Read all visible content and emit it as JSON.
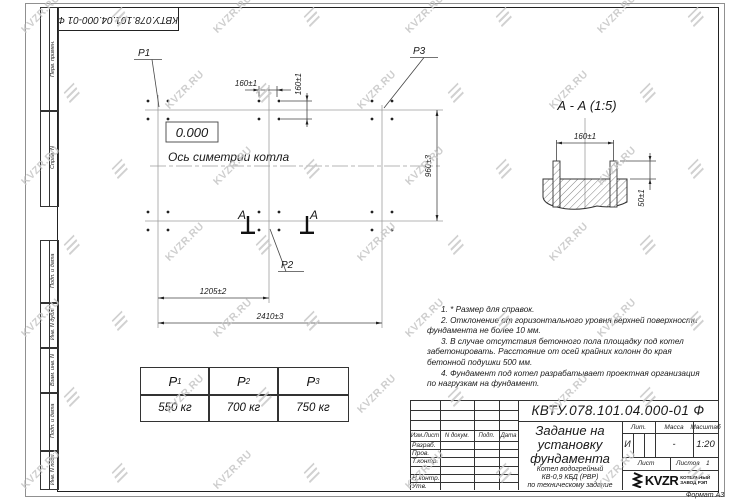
{
  "watermark": {
    "text": "KVZR.RU"
  },
  "frame": {
    "doc_number_top": "КВТУ.078.101.04.000-01 Ф",
    "margin_fields_top": [
      "Перв. примен.",
      "Справ. N"
    ],
    "margin_fields_bottom": [
      "Подп. и дата",
      "Инв. N дубл.",
      "Взам. инв. N",
      "Подп. и дата",
      "Инв. N подл."
    ],
    "format_label": "Формат А3"
  },
  "plan": {
    "level_mark": "0.000",
    "axis_label": "Ось симетрии котла",
    "labels": {
      "p1": "P1",
      "p2": "P2",
      "p3": "P3"
    },
    "section_letter": "А",
    "dims": {
      "bolt_h": "160±1",
      "bolt_v": "160±1",
      "width": "960±3",
      "half": "1205±2",
      "total": "2410±3"
    }
  },
  "section_view": {
    "title": "А - А (1:5)",
    "dims": {
      "spacing": "160±1",
      "height": "50±1"
    }
  },
  "notes": [
    "1. * Размер для справок.",
    "2. Отклонение от горизонтального уровня верхней поверхности фундамента не более 10 мм.",
    "3. В случае отсутствия бетонного пола площадку под котел забетонировать. Расстояние от осей крайних колонн до края бетонной подушки 500 мм.",
    "4. Фундамент под котел разрабатывает проектная организация по нагрузкам на фундамент."
  ],
  "loads_table": {
    "columns": [
      {
        "name": "P",
        "sub": "1",
        "value": "550 кг"
      },
      {
        "name": "P",
        "sub": "2",
        "value": "700 кг"
      },
      {
        "name": "P",
        "sub": "3",
        "value": "750 кг"
      }
    ]
  },
  "title_block": {
    "doc_number": "КВТУ.078.101.04.000-01 Ф",
    "title": "Задание на установку фундамента",
    "product_lines": [
      "Котел водогрейный",
      "КВ-0,9 КБД (РВР)",
      "по техническому задание"
    ],
    "header_cols": [
      "Изм.Лист",
      "N докум.",
      "Подп.",
      "Дата"
    ],
    "sig_rows": [
      "Разраб.",
      "Пров.",
      "Т.контр.",
      "Н.контр.",
      "Утв."
    ],
    "lit": {
      "label": "Лит.",
      "value": "И"
    },
    "mass": {
      "label": "Масса",
      "value": "-"
    },
    "scale": {
      "label": "Масштаб",
      "value": "1:20"
    },
    "sheet": {
      "label": "Лист"
    },
    "sheets": {
      "label": "Листов",
      "value": "1"
    },
    "company": {
      "logo_text": "KVZR",
      "line1": "КОТЕЛЬНЫЙ",
      "line2": "ЗАВОД РЭП"
    }
  }
}
